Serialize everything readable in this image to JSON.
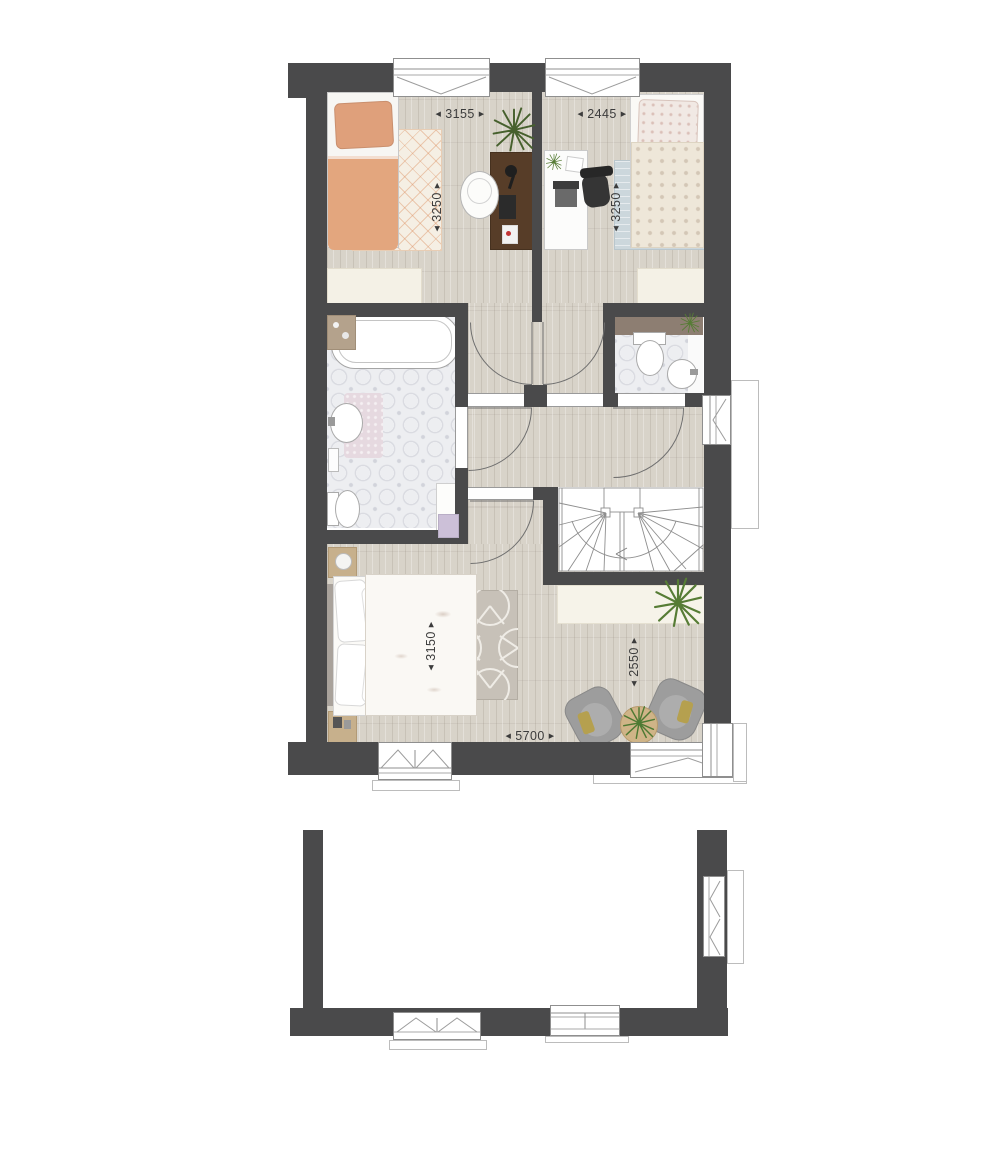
{
  "dimensions": {
    "bedroom1_width": "3155",
    "bedroom2_width": "2445",
    "bedroom1_depth": "3250",
    "bedroom2_depth": "3250",
    "master_bedroom_depth": "3150",
    "sitting_area_depth": "2550",
    "master_bedroom_width": "5700"
  },
  "glyphs": {
    "arrow_start": "◀",
    "arrow_end": "▶"
  },
  "colors": {
    "wall": "#4a4a4b",
    "floor": "#d8d3c9",
    "tile": "#edeef1",
    "window_stroke": "#8f8f8f",
    "door_stroke": "#6f6f6f",
    "stair_stroke": "#8e8e8e",
    "dim_text": "#3c3c3c",
    "duvet_orange": "#e3a67e",
    "pillow_orange": "#dfa07b",
    "rug_cream": "#f5efe4",
    "rug_blue": "#ccd7dc",
    "bed_pattern": "#eee7d9",
    "desk_wood": "#573d28",
    "chair_dark": "#353535",
    "shelf_brown": "#8d7e72",
    "nightstand_wood": "#c7b08c",
    "armchair_grey": "#9d9d9d",
    "cushion_olive": "#b5a04f",
    "plant_green": "#567c35",
    "plant_dark": "#46602d",
    "mat_pink": "#e6d9e0",
    "towel_purple": "#ccc0d8",
    "ledge_cream": "#f6f3e9",
    "wardrobe_cream": "#f4f1e6"
  }
}
